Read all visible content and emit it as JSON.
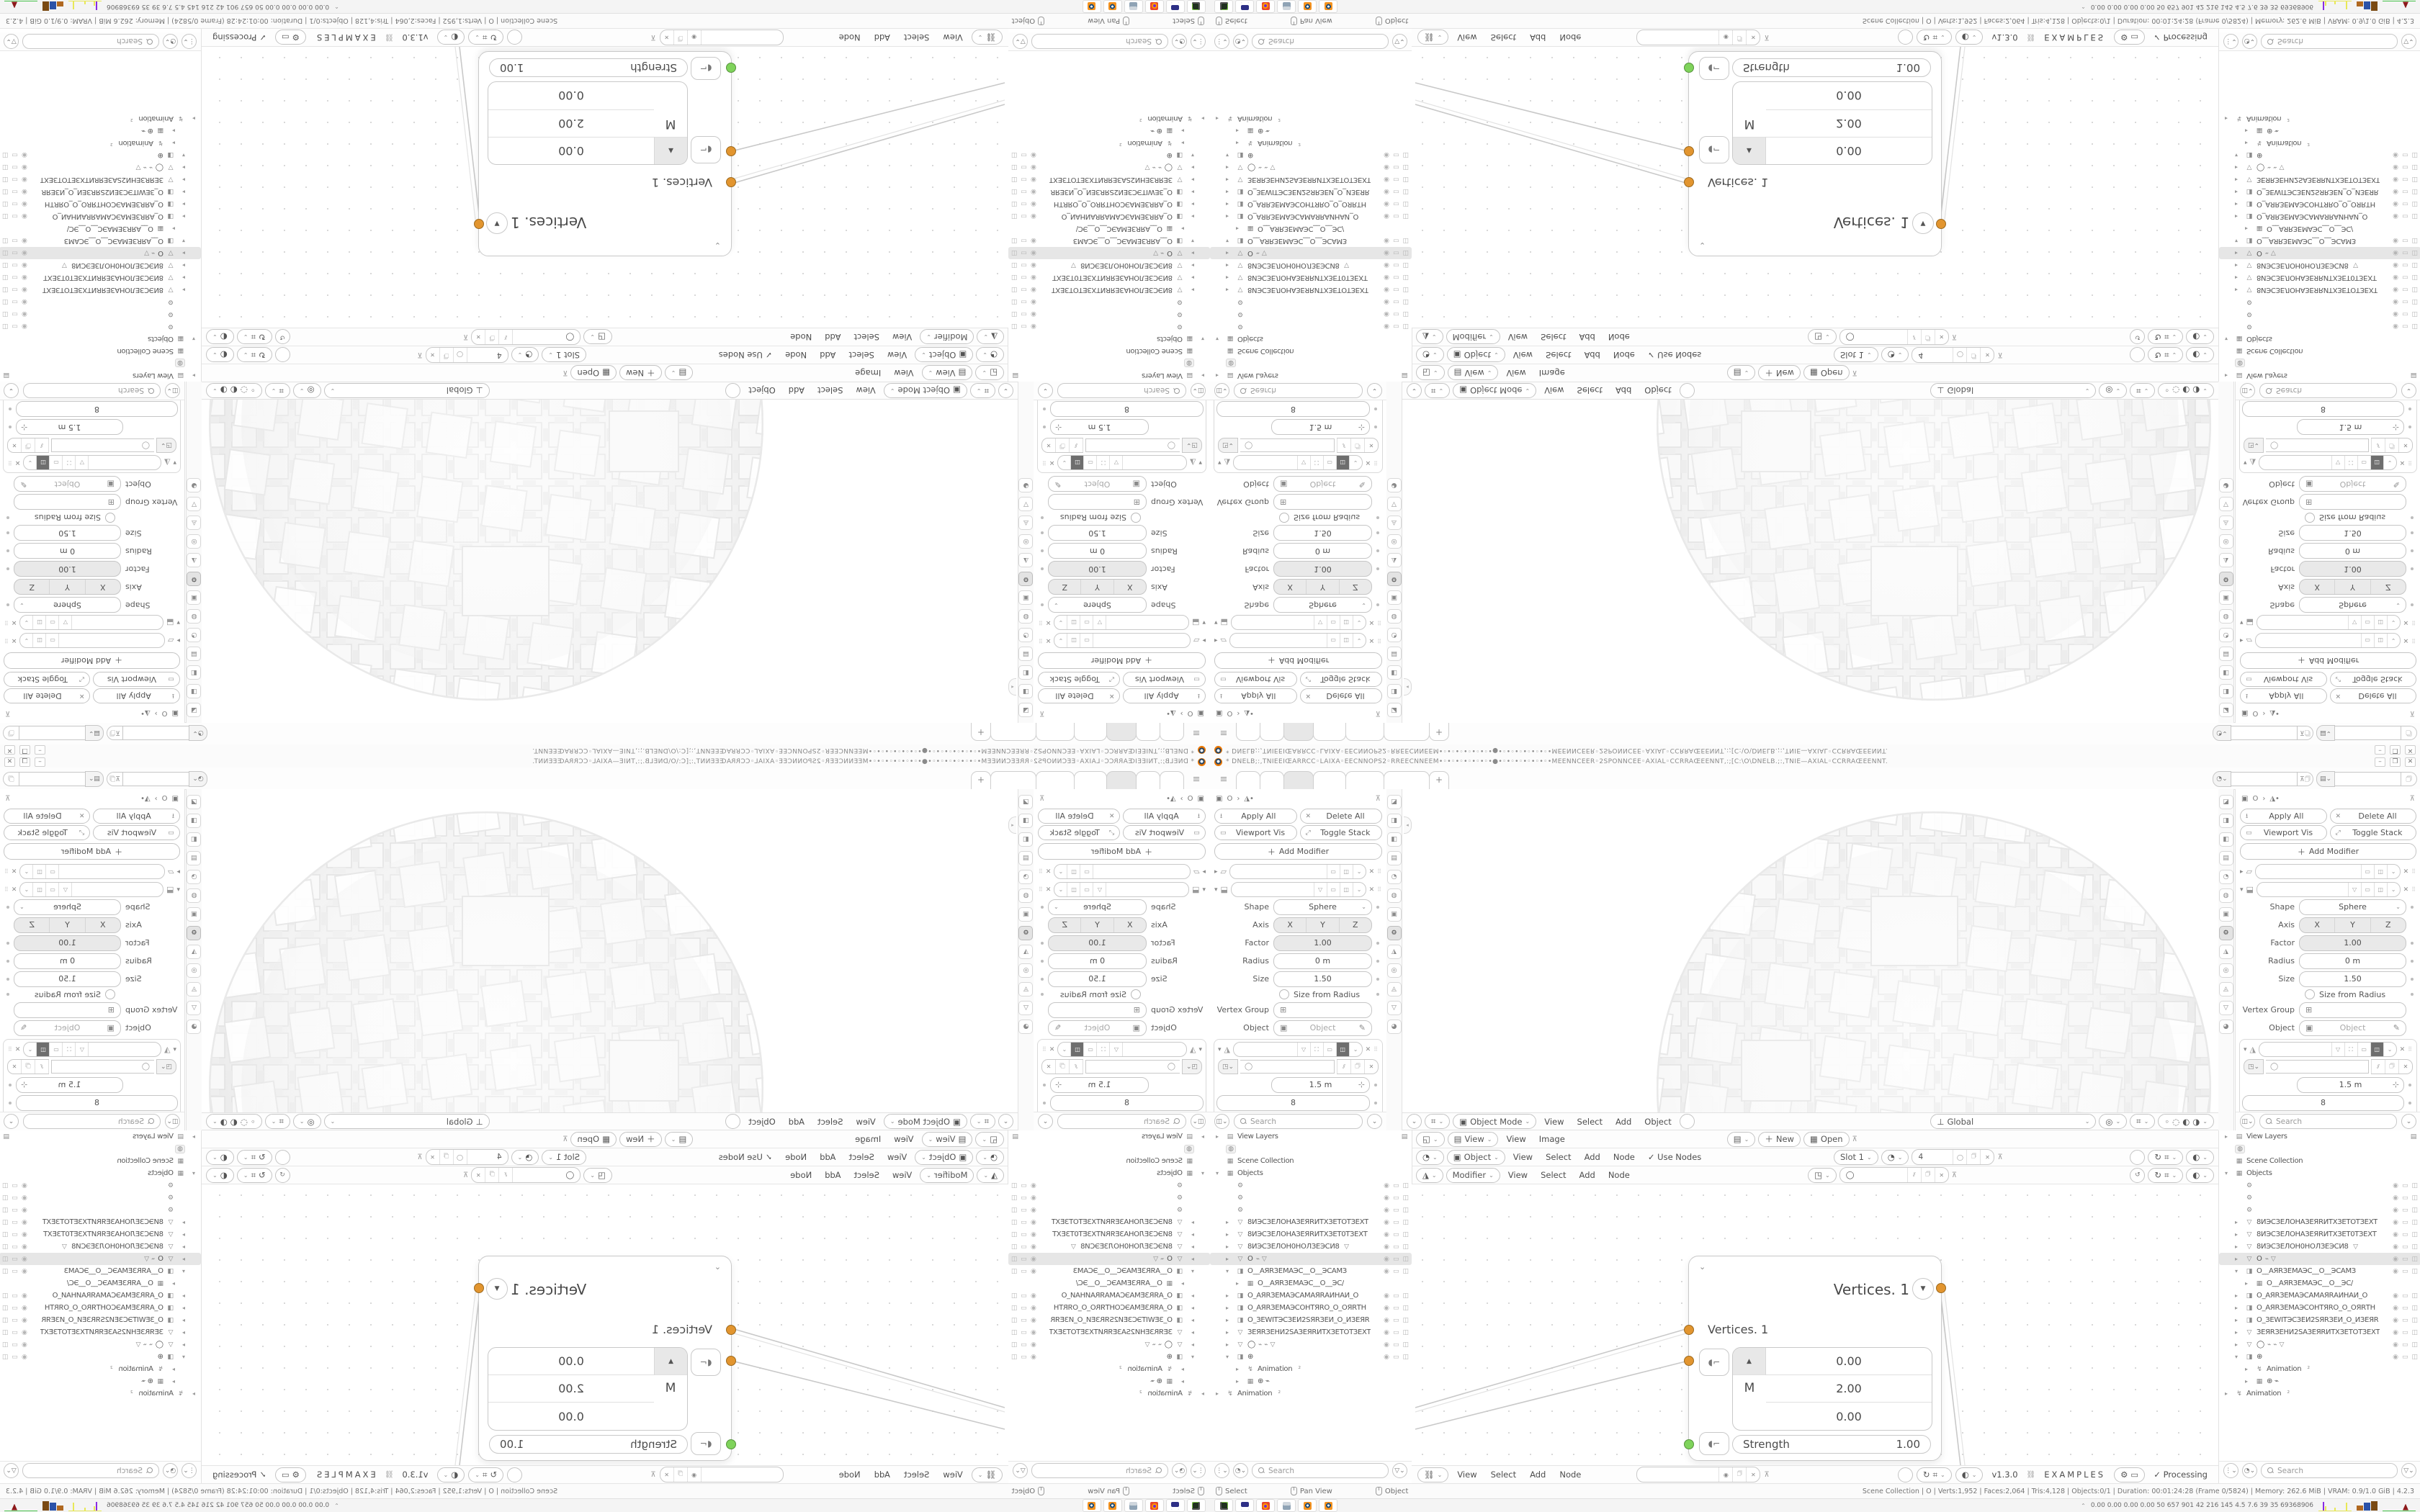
{
  "window": {
    "title": "* DNELB;:,TNIEEIŒARRCC◦LAIXA◦EECNNOPS2◦RREECNNEEM•◦•◦•◦•◦•◦•◦•●•◦•◦•◦•◦•◦•◦•MEENNCEER◦2SPONNCEE◦AXIAL◦CCRRAŒEENNT,:;[C:\\O\\DNELB.;:,TNIE—AXIAL◦CCRRAŒEENNT.",
    "minimize": "–",
    "maximize": "❐",
    "close": "✕"
  },
  "tabs": {
    "widths": [
      32,
      32,
      40,
      44,
      52,
      62
    ],
    "active_index": 2,
    "add": "+"
  },
  "properties": {
    "crumb_obj": "O",
    "apply_all": "Apply All",
    "delete_all": "Delete All",
    "viewport_vis": "Viewport Vis",
    "toggle_stack": "Toggle Stack",
    "add_modifier": "Add Modifier",
    "shape_label": "Shape",
    "shape_value": "Sphere",
    "axis_label": "Axis",
    "axis_x": "X",
    "axis_y": "Y",
    "axis_z": "Z",
    "factor_label": "Factor",
    "factor_value": "1.00",
    "radius_label": "Radius",
    "radius_value": "0 m",
    "size_label": "Size",
    "size_value": "1.50",
    "size_from_radius": "Size from Radius",
    "vertex_group_label": "Vertex Group",
    "object_label": "Object",
    "object_placeholder": "Object",
    "node_size_value": "1.5 m",
    "node_count_value": "8",
    "output_attributes": "Output Attributes",
    "manage": "Manage",
    "search_placeholder": "Search",
    "tab_icons": [
      "◪",
      "◨",
      "◧",
      "▤",
      "◔",
      "◍",
      "▣",
      "⚙",
      "◮",
      "◎",
      "◬",
      "▽",
      "◕"
    ],
    "active_tab_index": 7
  },
  "viewport": {
    "mode": "Object Mode",
    "menus": [
      "View",
      "Select",
      "Add",
      "Object"
    ],
    "orientation": "Global"
  },
  "image_editor": {
    "view_mode": "View",
    "menus": [
      "View",
      "Image"
    ],
    "new_label": "New",
    "open_label": "Open"
  },
  "texture_editor": {
    "type_value": "Object",
    "menus": [
      "View",
      "Select",
      "Add",
      "Node"
    ],
    "use_nodes": "Use Nodes",
    "slot": "Slot 1",
    "datablock": "4"
  },
  "geonode_editor": {
    "type_value": "Modifier",
    "menus": [
      "View",
      "Select",
      "Add",
      "Node"
    ]
  },
  "node_editor": {
    "menus": [
      "View",
      "Select",
      "Add",
      "Node"
    ],
    "version": "v1.3.0",
    "examples": "EXAMPLES",
    "processing": "Processing",
    "node": {
      "title": "Vertices. 1",
      "input_label": "Vertices. 1",
      "axis_letter": "M",
      "values": [
        "0.00",
        "2.00",
        "0.00"
      ],
      "strength_label": "Strength",
      "strength_value": "1.00"
    }
  },
  "outliner": {
    "view_layers": "View Layers",
    "scene_collection": "Scene Collection",
    "objects": "Objects",
    "search_placeholder": "Search",
    "items": [
      {
        "chev": "",
        "icon": "⚙",
        "name": "",
        "ind": 1,
        "vis": true
      },
      {
        "chev": "",
        "icon": "⚙",
        "name": "",
        "ind": 1,
        "vis": true
      },
      {
        "chev": "",
        "icon": "⚙",
        "name": "",
        "ind": 1,
        "vis": true
      },
      {
        "chev": "▸",
        "icon": "▽",
        "name": "8ИЭСЗЕЛОНАЗЕЯRИТХЗЕТОТЗЕХТ",
        "ind": 1,
        "vis": true
      },
      {
        "chev": "▸",
        "icon": "▽",
        "name": "8ИЭСЗЕЛОНАЗЕЯRИТХЗЕТ0ТЗЕХТ",
        "ind": 1,
        "vis": true
      },
      {
        "chev": "▸",
        "icon": "▽",
        "name": "8ИЭСЗЕЛОН0НОЛЗЕЭСИ8",
        "extra": "▽",
        "ind": 1,
        "vis": true
      },
      {
        "chev": "▸",
        "icon": "▽",
        "name": "O",
        "extra": "⌁ ▽",
        "ind": 1,
        "vis": true,
        "selected": true
      },
      {
        "chev": "▾",
        "icon": "◨",
        "name": "O__AЯRЗЕМАЭС__O__ЭСАМЗ",
        "ind": 1,
        "vis": true
      },
      {
        "chev": "▸",
        "icon": "▦",
        "name": "O__AЯRЗЕМАЭС__O__ЭС/",
        "ind": 2,
        "vis": false
      },
      {
        "chev": "▸",
        "icon": "◨",
        "name": "O_AЯRЗЕМАЭСAMAЯRАИНАИ_О",
        "ind": 1,
        "vis": true
      },
      {
        "chev": "▸",
        "icon": "◨",
        "name": "O_AЯRЗЕМАЭСOHТЯRO_О_ОЯRТН",
        "ind": 1,
        "vis": true
      },
      {
        "chev": "▸",
        "icon": "◨",
        "name": "O_ЗЕWІТЭСЗЕИ2SЯRЗЕИ_О_ИЗЕЯR",
        "ind": 1,
        "vis": true
      },
      {
        "chev": "▸",
        "icon": "▽",
        "name": "ЗЕЯRЗЕНИ2SАЗЕЯRИТХЗЕТОТЗЕХТ",
        "ind": 1,
        "vis": true
      },
      {
        "chev": "▸",
        "icon": "▽",
        "name": "◯",
        "extra": "⌁ ⌁ ▽",
        "ind": 1,
        "vis": true
      },
      {
        "chev": "▾",
        "icon": "◨",
        "name": "⊕",
        "ind": 1,
        "vis": true
      },
      {
        "chev": "▸",
        "icon": "↯",
        "name": "Animation",
        "extra": "²",
        "ind": 2,
        "vis": false
      },
      {
        "chev": "▸",
        "icon": "▦",
        "name": "⊕  ⌁",
        "ind": 2,
        "vis": false
      },
      {
        "chev": "▸",
        "icon": "↯",
        "name": "Animation",
        "extra": "²",
        "ind": 0,
        "vis": false
      }
    ]
  },
  "status": {
    "hint_select": "Select",
    "hint_pan": "Pan View",
    "hint_object": "Object",
    "info": "Scene Collection | O | Verts:1,952 | Faces:2,064 | Tris:4,128 | Objects:0/1 | Duration: 00:01:24:28 (Frame 0/5824) | Memory: 262.6 MiB | VRAM: 0.9/1.0 GiB | 4.2.3"
  },
  "taskbar": {
    "apps": [
      "terminal",
      "floppy64",
      "firefox",
      "calculator",
      "blender",
      "blender"
    ],
    "monitor_values": "0.00 0.00 0.00 0.00   50   657   901   42   216   145   4.5   7.6   39   35   69368906"
  },
  "colors": {
    "socket_orange": "#e2952f",
    "socket_green": "#7fd35b",
    "blender_orange": "#ea7600",
    "bar_brown": "#b06820",
    "bar_blue": "#2b52a8",
    "bar_dark_brown": "#7a4a14",
    "spark_yellow": "#e8e857",
    "spark_purple": "#8a2be2",
    "area_red": "#8c1a1a",
    "line_green": "#46c24a"
  }
}
